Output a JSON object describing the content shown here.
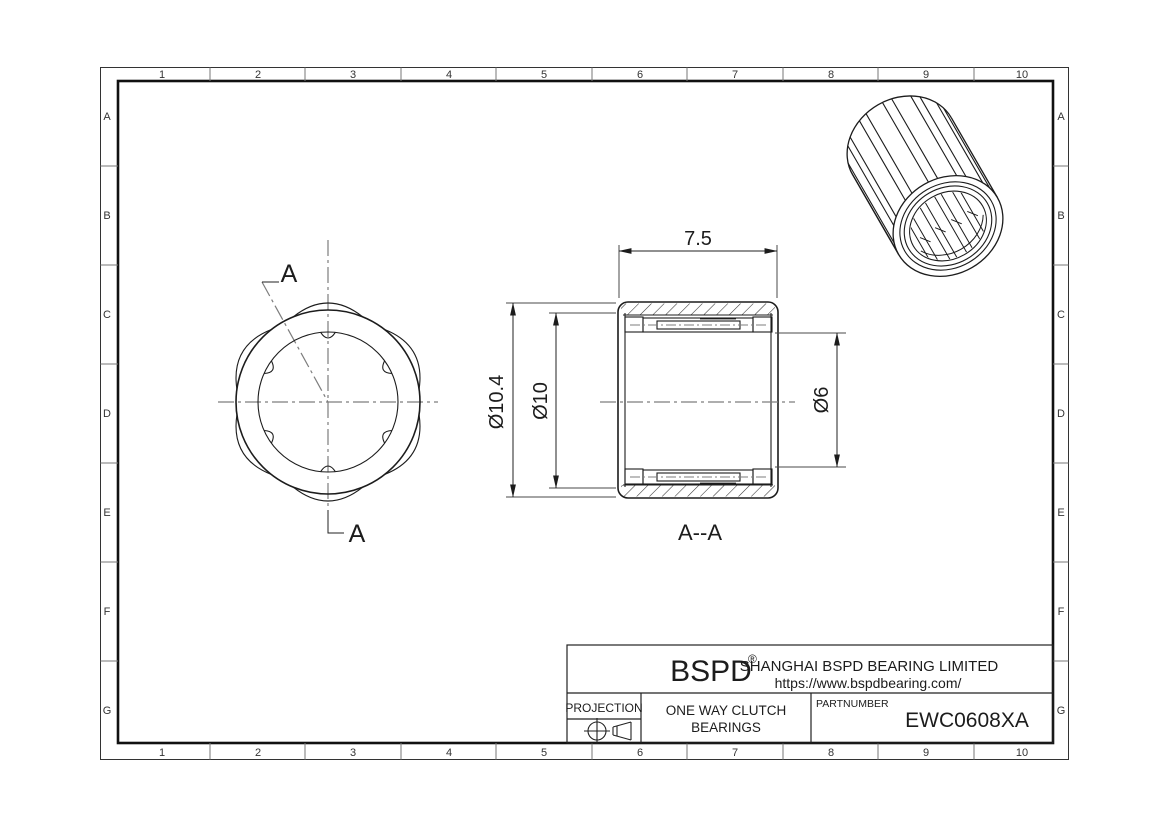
{
  "sheet": {
    "bg": "#ffffff",
    "line_color": "#1c1c1c",
    "centerline_color": "#7d7d7d"
  },
  "zones": {
    "columns": [
      "1",
      "2",
      "3",
      "4",
      "5",
      "6",
      "7",
      "8",
      "9",
      "10"
    ],
    "rows": [
      "A",
      "B",
      "C",
      "D",
      "E",
      "F",
      "G"
    ]
  },
  "front_view": {
    "cut_label_top": "A",
    "cut_label_bottom": "A"
  },
  "section_view": {
    "label": "A--A",
    "dim_width": "7.5",
    "dim_outer_diameter": "Ø10.4",
    "dim_shell_diameter": "Ø10",
    "dim_bore_diameter": "Ø6"
  },
  "title_block": {
    "brand": "BSPD",
    "registered_mark": "®",
    "company": "SHANGHAI BSPD BEARING LIMITED",
    "website": "https://www.bspdbearing.com/",
    "projection_label": "PROJECTION",
    "product_line1": "ONE WAY CLUTCH",
    "product_line2": "BEARINGS",
    "partnumber_label": "PARTNUMBER",
    "partnumber": "EWC0608XA"
  }
}
